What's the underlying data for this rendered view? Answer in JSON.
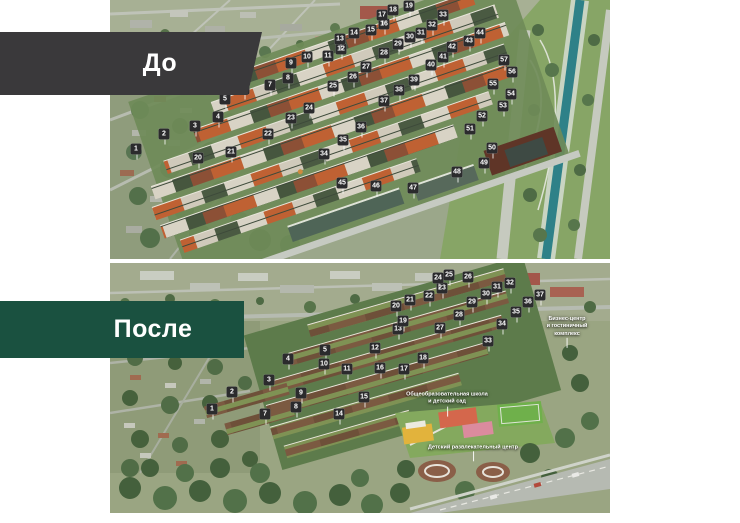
{
  "colors": {
    "before_banner": "#3a393b",
    "after_banner": "#1a5140",
    "marker_bg": "#2b2b2d",
    "marker_text": "#ffffff",
    "annotation_text": "#ffffff",
    "canal_water": "#2e8188",
    "park_green": "#87a566"
  },
  "before": {
    "label": "До",
    "markers": [
      {
        "n": "1",
        "x": 26,
        "y": 149
      },
      {
        "n": "2",
        "x": 54,
        "y": 134
      },
      {
        "n": "3",
        "x": 85,
        "y": 126
      },
      {
        "n": "4",
        "x": 108,
        "y": 117
      },
      {
        "n": "5",
        "x": 115,
        "y": 99
      },
      {
        "n": "6",
        "x": 134,
        "y": 89
      },
      {
        "n": "7",
        "x": 160,
        "y": 85
      },
      {
        "n": "8",
        "x": 178,
        "y": 78
      },
      {
        "n": "9",
        "x": 181,
        "y": 63
      },
      {
        "n": "10",
        "x": 197,
        "y": 57
      },
      {
        "n": "11",
        "x": 218,
        "y": 56
      },
      {
        "n": "12",
        "x": 231,
        "y": 49
      },
      {
        "n": "13",
        "x": 230,
        "y": 39
      },
      {
        "n": "14",
        "x": 244,
        "y": 33
      },
      {
        "n": "15",
        "x": 261,
        "y": 30
      },
      {
        "n": "16",
        "x": 274,
        "y": 24
      },
      {
        "n": "17",
        "x": 272,
        "y": 15
      },
      {
        "n": "18",
        "x": 283,
        "y": 10
      },
      {
        "n": "19",
        "x": 299,
        "y": 6
      },
      {
        "n": "20",
        "x": 88,
        "y": 158
      },
      {
        "n": "21",
        "x": 121,
        "y": 152
      },
      {
        "n": "22",
        "x": 158,
        "y": 134
      },
      {
        "n": "23",
        "x": 181,
        "y": 118
      },
      {
        "n": "24",
        "x": 199,
        "y": 108
      },
      {
        "n": "25",
        "x": 223,
        "y": 86
      },
      {
        "n": "26",
        "x": 243,
        "y": 77
      },
      {
        "n": "27",
        "x": 256,
        "y": 67
      },
      {
        "n": "28",
        "x": 274,
        "y": 53
      },
      {
        "n": "29",
        "x": 288,
        "y": 44
      },
      {
        "n": "30",
        "x": 300,
        "y": 37
      },
      {
        "n": "31",
        "x": 311,
        "y": 33
      },
      {
        "n": "32",
        "x": 322,
        "y": 25
      },
      {
        "n": "33",
        "x": 333,
        "y": 15
      },
      {
        "n": "34",
        "x": 214,
        "y": 154
      },
      {
        "n": "35",
        "x": 233,
        "y": 140
      },
      {
        "n": "36",
        "x": 251,
        "y": 127
      },
      {
        "n": "37",
        "x": 274,
        "y": 101
      },
      {
        "n": "38",
        "x": 289,
        "y": 90
      },
      {
        "n": "39",
        "x": 304,
        "y": 80
      },
      {
        "n": "40",
        "x": 321,
        "y": 65
      },
      {
        "n": "41",
        "x": 333,
        "y": 57
      },
      {
        "n": "42",
        "x": 342,
        "y": 47
      },
      {
        "n": "43",
        "x": 359,
        "y": 41
      },
      {
        "n": "44",
        "x": 370,
        "y": 33
      },
      {
        "n": "45",
        "x": 232,
        "y": 183
      },
      {
        "n": "46",
        "x": 266,
        "y": 186
      },
      {
        "n": "47",
        "x": 303,
        "y": 188
      },
      {
        "n": "48",
        "x": 347,
        "y": 172
      },
      {
        "n": "49",
        "x": 374,
        "y": 163
      },
      {
        "n": "50",
        "x": 382,
        "y": 148
      },
      {
        "n": "51",
        "x": 360,
        "y": 129
      },
      {
        "n": "52",
        "x": 372,
        "y": 116
      },
      {
        "n": "53",
        "x": 393,
        "y": 106
      },
      {
        "n": "54",
        "x": 401,
        "y": 94
      },
      {
        "n": "55",
        "x": 383,
        "y": 84
      },
      {
        "n": "56",
        "x": 402,
        "y": 72
      },
      {
        "n": "57",
        "x": 394,
        "y": 60
      }
    ]
  },
  "after": {
    "label": "После",
    "markers": [
      {
        "n": "1",
        "x": 102,
        "y": 146
      },
      {
        "n": "2",
        "x": 122,
        "y": 129
      },
      {
        "n": "3",
        "x": 159,
        "y": 117
      },
      {
        "n": "4",
        "x": 178,
        "y": 96
      },
      {
        "n": "5",
        "x": 215,
        "y": 87
      },
      {
        "n": "7",
        "x": 155,
        "y": 151
      },
      {
        "n": "8",
        "x": 186,
        "y": 144
      },
      {
        "n": "9",
        "x": 191,
        "y": 130
      },
      {
        "n": "10",
        "x": 214,
        "y": 101
      },
      {
        "n": "11",
        "x": 237,
        "y": 106
      },
      {
        "n": "12",
        "x": 265,
        "y": 85
      },
      {
        "n": "13",
        "x": 288,
        "y": 66
      },
      {
        "n": "14",
        "x": 229,
        "y": 151
      },
      {
        "n": "15",
        "x": 254,
        "y": 134
      },
      {
        "n": "16",
        "x": 270,
        "y": 105
      },
      {
        "n": "17",
        "x": 294,
        "y": 106
      },
      {
        "n": "18",
        "x": 313,
        "y": 95
      },
      {
        "n": "19",
        "x": 293,
        "y": 58
      },
      {
        "n": "20",
        "x": 286,
        "y": 43
      },
      {
        "n": "21",
        "x": 300,
        "y": 37
      },
      {
        "n": "22",
        "x": 319,
        "y": 33
      },
      {
        "n": "23",
        "x": 332,
        "y": 25
      },
      {
        "n": "24",
        "x": 328,
        "y": 15
      },
      {
        "n": "25",
        "x": 339,
        "y": 12
      },
      {
        "n": "26",
        "x": 358,
        "y": 14
      },
      {
        "n": "27",
        "x": 330,
        "y": 65
      },
      {
        "n": "28",
        "x": 349,
        "y": 52
      },
      {
        "n": "29",
        "x": 362,
        "y": 39
      },
      {
        "n": "30",
        "x": 376,
        "y": 31
      },
      {
        "n": "31",
        "x": 387,
        "y": 24
      },
      {
        "n": "32",
        "x": 400,
        "y": 20
      },
      {
        "n": "33",
        "x": 378,
        "y": 78
      },
      {
        "n": "34",
        "x": 392,
        "y": 61
      },
      {
        "n": "35",
        "x": 406,
        "y": 49
      },
      {
        "n": "36",
        "x": 418,
        "y": 39
      },
      {
        "n": "37",
        "x": 430,
        "y": 32
      }
    ],
    "annotations": [
      {
        "text": "Бизнес-центр\nи гостиничный\nкомплекс",
        "x": 457,
        "y": 64
      },
      {
        "text": "Общеобразовательная школа\nи детский сад",
        "x": 337,
        "y": 136
      },
      {
        "text": "Детский развлекательный центр",
        "x": 363,
        "y": 185
      }
    ]
  }
}
